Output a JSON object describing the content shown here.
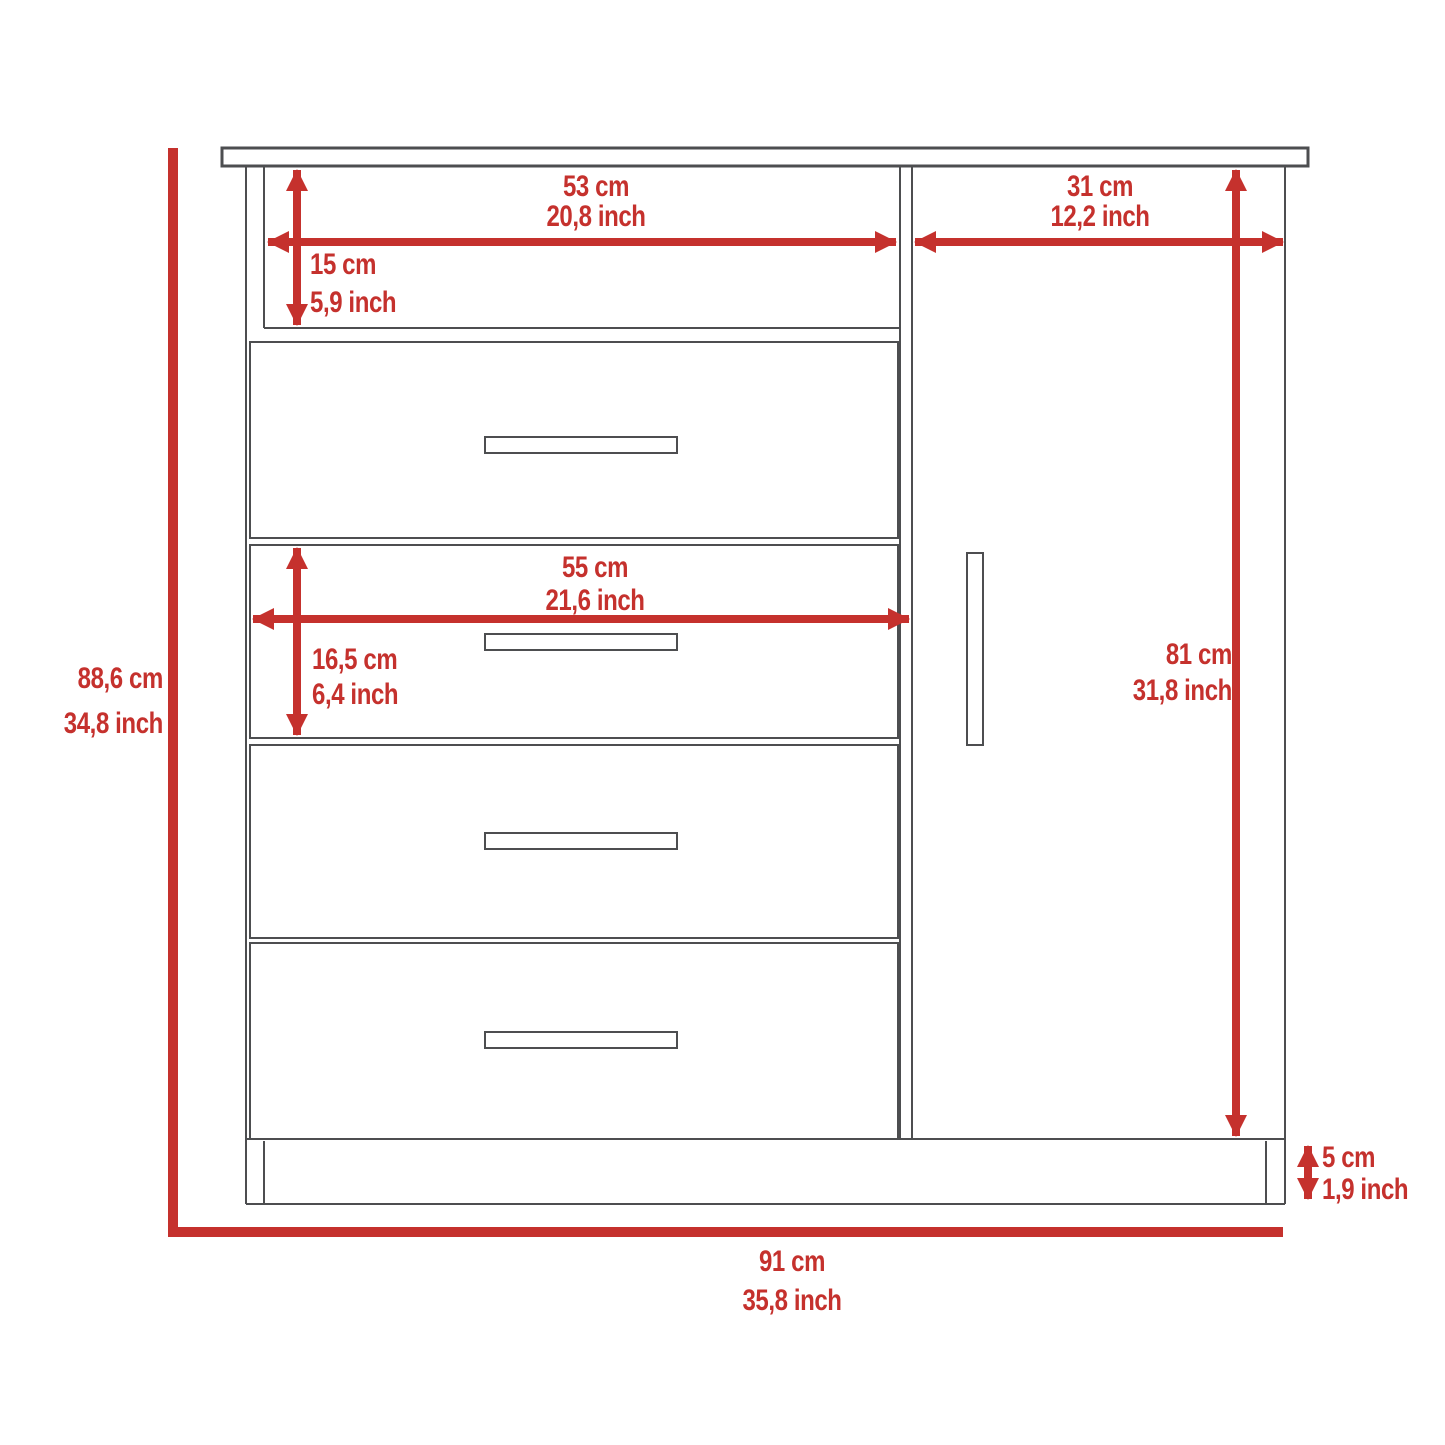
{
  "diagram": {
    "kind": "furniture-dimension-drawing",
    "subject": "dresser with open top shelf, four drawers and side door on plinth base"
  },
  "colors": {
    "dimension": "#c5312d",
    "outline": "#4d4e50",
    "background": "#ffffff"
  },
  "dims": {
    "shelf_width": {
      "cm": "53 cm",
      "inch": "20,8 inch"
    },
    "door_width": {
      "cm": "31 cm",
      "inch": "12,2 inch"
    },
    "shelf_height": {
      "cm": "15 cm",
      "inch": "5,9 inch"
    },
    "drawer_width": {
      "cm": "55 cm",
      "inch": "21,6 inch"
    },
    "drawer_height": {
      "cm": "16,5 cm",
      "inch": "6,4 inch"
    },
    "door_height": {
      "cm": "81 cm",
      "inch": "31,8 inch"
    },
    "overall_height": {
      "cm": "88,6 cm",
      "inch": "34,8 inch"
    },
    "base_height": {
      "cm": "5 cm",
      "inch": "1,9 inch"
    },
    "overall_width": {
      "cm": "91 cm",
      "inch": "35,8 inch"
    }
  }
}
